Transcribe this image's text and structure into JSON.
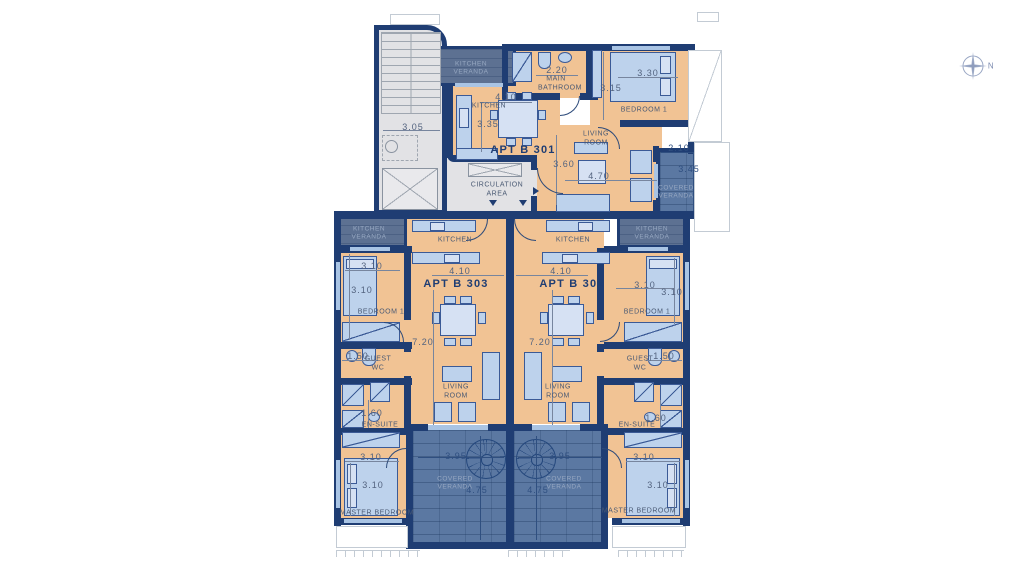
{
  "document": {
    "type": "apartment-floor-plan",
    "apartment_names": [
      "APT B 301",
      "APT B 302",
      "APT B 303"
    ]
  },
  "colors": {
    "wall": "#1f3d73",
    "floor": "#f1c394",
    "covered_veranda": "#5b78a2",
    "kitchen_veranda": "#5d7192",
    "furniture": "#bdd2ec",
    "circulation": "#e2e2e5"
  },
  "labels": [
    {
      "name": "b301-kitchen-veranda-label",
      "text": "KITCHEN VERANDA",
      "x": 471,
      "y": 69,
      "cls": "ver"
    },
    {
      "name": "b301-bathroom-dim-width",
      "text": "2.20",
      "x": 557,
      "y": 70,
      "cls": "dim"
    },
    {
      "name": "b301-bathroom-label",
      "text": "MAIN BATHROOM",
      "x": 556,
      "y": 84,
      "cls": "room3"
    },
    {
      "name": "b301-bedroom1-dim-width",
      "text": "3.30",
      "x": 648,
      "y": 73,
      "cls": "dim"
    },
    {
      "name": "b301-bedroom1-dim-height",
      "text": "3.15",
      "x": 611,
      "y": 88,
      "cls": "dim"
    },
    {
      "name": "b301-bedroom1-label",
      "text": "BEDROOM 1",
      "x": 644,
      "y": 110,
      "cls": "room"
    },
    {
      "name": "b301-kitchen-dim-width",
      "text": "4.10",
      "x": 506,
      "y": 97,
      "cls": "dim"
    },
    {
      "name": "b301-kitchen-label",
      "text": "KITCHEN",
      "x": 489,
      "y": 106,
      "cls": "room"
    },
    {
      "name": "b301-kitchen-dim-height",
      "text": "3.35",
      "x": 488,
      "y": 124,
      "cls": "dim"
    },
    {
      "name": "b301-apartment-label",
      "text": "APT  B 301",
      "x": 523,
      "y": 150,
      "cls": "apt"
    },
    {
      "name": "b301-living-label",
      "text": "LIVING ROOM",
      "x": 596,
      "y": 139,
      "cls": "room3"
    },
    {
      "name": "b301-living-dim-height",
      "text": "3.60",
      "x": 564,
      "y": 164,
      "cls": "dim"
    },
    {
      "name": "b301-living-dim-width",
      "text": "4.70",
      "x": 599,
      "y": 176,
      "cls": "dim"
    },
    {
      "name": "b301-veranda-dim-width",
      "text": "2.10",
      "x": 679,
      "y": 148,
      "cls": "dim2"
    },
    {
      "name": "b301-veranda-dim-height",
      "text": "3.45",
      "x": 689,
      "y": 169,
      "cls": "dim2"
    },
    {
      "name": "b301-veranda-label",
      "text": "COVERED VERANDA",
      "x": 676,
      "y": 193,
      "cls": "ver"
    },
    {
      "name": "circulation-area-label",
      "text": "CIRCULATION AREA",
      "x": 497,
      "y": 190,
      "cls": "room2"
    },
    {
      "name": "core-dim-width",
      "text": "3.05",
      "x": 413,
      "y": 127,
      "cls": "dim"
    },
    {
      "name": "b303-kitchen-veranda-label",
      "text": "KITCHEN VERANDA",
      "x": 369,
      "y": 234,
      "cls": "ver"
    },
    {
      "name": "b303-kitchen-label",
      "text": "KITCHEN",
      "x": 455,
      "y": 240,
      "cls": "room"
    },
    {
      "name": "b303-bedroom1-dim-width",
      "text": "3.10",
      "x": 372,
      "y": 266,
      "cls": "dim"
    },
    {
      "name": "b303-bedroom1-dim-height",
      "text": "3.10",
      "x": 362,
      "y": 290,
      "cls": "dim"
    },
    {
      "name": "b303-bedroom1-label",
      "text": "BEDROOM 1",
      "x": 381,
      "y": 312,
      "cls": "room"
    },
    {
      "name": "b303-dim-width",
      "text": "4.10",
      "x": 460,
      "y": 271,
      "cls": "dim"
    },
    {
      "name": "b303-apartment-label",
      "text": "APT  B 303",
      "x": 456,
      "y": 284,
      "cls": "apt"
    },
    {
      "name": "b303-dim-height",
      "text": "7.20",
      "x": 423,
      "y": 342,
      "cls": "dim"
    },
    {
      "name": "b303-guestwc-dim",
      "text": "1.50",
      "x": 358,
      "y": 356,
      "cls": "dim"
    },
    {
      "name": "b303-guestwc-label",
      "text": "GUEST WC",
      "x": 378,
      "y": 364,
      "cls": "room3"
    },
    {
      "name": "b303-ensuite-dim",
      "text": "1.60",
      "x": 372,
      "y": 413,
      "cls": "dim"
    },
    {
      "name": "b303-ensuite-label",
      "text": "EN-SUITE",
      "x": 380,
      "y": 425,
      "cls": "room"
    },
    {
      "name": "b303-living-label",
      "text": "LIVING ROOM",
      "x": 456,
      "y": 392,
      "cls": "room3"
    },
    {
      "name": "b303-master-dim-width",
      "text": "3.10",
      "x": 371,
      "y": 457,
      "cls": "dim"
    },
    {
      "name": "b303-master-dim-height",
      "text": "3.10",
      "x": 373,
      "y": 485,
      "cls": "dim"
    },
    {
      "name": "b303-master-label",
      "text": "MASTER BEDROOM",
      "x": 377,
      "y": 513,
      "cls": "room"
    },
    {
      "name": "b303-veranda-dim-width",
      "text": "3.95",
      "x": 456,
      "y": 456,
      "cls": "dim2"
    },
    {
      "name": "b303-veranda-label",
      "text": "COVERED VERANDA",
      "x": 455,
      "y": 484,
      "cls": "ver"
    },
    {
      "name": "b303-veranda-dim-height",
      "text": "4.75",
      "x": 477,
      "y": 490,
      "cls": "dim2"
    },
    {
      "name": "b302-kitchen-label",
      "text": "KITCHEN",
      "x": 573,
      "y": 240,
      "cls": "room"
    },
    {
      "name": "b302-kitchen-veranda-label",
      "text": "KITCHEN VERANDA",
      "x": 652,
      "y": 234,
      "cls": "ver"
    },
    {
      "name": "b302-dim-width",
      "text": "4.10",
      "x": 561,
      "y": 271,
      "cls": "dim"
    },
    {
      "name": "b302-apartment-label",
      "text": "APT  B 302",
      "x": 572,
      "y": 284,
      "cls": "apt"
    },
    {
      "name": "b302-bedroom1-dim-width",
      "text": "3.10",
      "x": 645,
      "y": 285,
      "cls": "dim"
    },
    {
      "name": "b302-bedroom1-dim-height",
      "text": "3.10",
      "x": 672,
      "y": 292,
      "cls": "dim"
    },
    {
      "name": "b302-bedroom1-label",
      "text": "BEDROOM 1",
      "x": 647,
      "y": 312,
      "cls": "room"
    },
    {
      "name": "b302-dim-height",
      "text": "7.20",
      "x": 540,
      "y": 342,
      "cls": "dim"
    },
    {
      "name": "b302-guestwc-label",
      "text": "GUEST WC",
      "x": 640,
      "y": 364,
      "cls": "room3"
    },
    {
      "name": "b302-guestwc-dim",
      "text": "1.50",
      "x": 664,
      "y": 356,
      "cls": "dim"
    },
    {
      "name": "b302-ensuite-label",
      "text": "EN-SUITE",
      "x": 637,
      "y": 425,
      "cls": "room"
    },
    {
      "name": "b302-ensuite-dim",
      "text": "1.60",
      "x": 656,
      "y": 418,
      "cls": "dim"
    },
    {
      "name": "b302-living-label",
      "text": "LIVING ROOM",
      "x": 558,
      "y": 392,
      "cls": "room3"
    },
    {
      "name": "b302-veranda-dim-width",
      "text": "3.95",
      "x": 560,
      "y": 456,
      "cls": "dim2"
    },
    {
      "name": "b302-veranda-label",
      "text": "COVERED VERANDA",
      "x": 564,
      "y": 484,
      "cls": "ver"
    },
    {
      "name": "b302-veranda-dim-height",
      "text": "4.75",
      "x": 538,
      "y": 490,
      "cls": "dim2"
    },
    {
      "name": "b302-master-dim-width",
      "text": "3.10",
      "x": 644,
      "y": 457,
      "cls": "dim"
    },
    {
      "name": "b302-master-dim-height",
      "text": "3.10",
      "x": 658,
      "y": 485,
      "cls": "dim"
    },
    {
      "name": "b302-master-label",
      "text": "MASTER BEDROOM",
      "x": 639,
      "y": 511,
      "cls": "room"
    },
    {
      "name": "compass-north-label",
      "text": "N",
      "x": 991,
      "y": 66,
      "cls": "ncls"
    }
  ]
}
